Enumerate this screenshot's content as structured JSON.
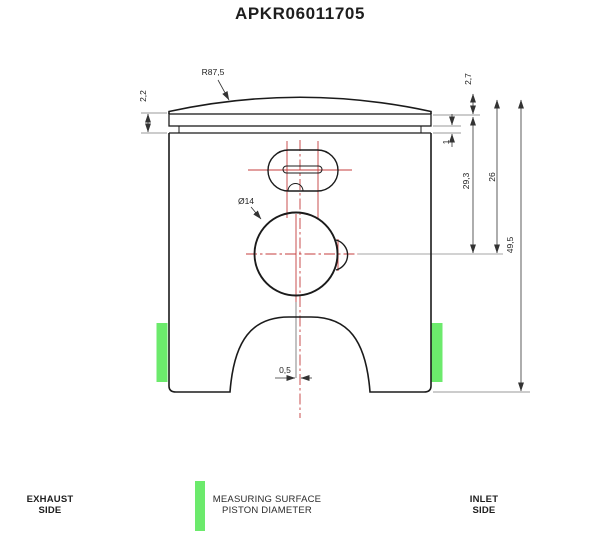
{
  "title": "APKR06011705",
  "colors": {
    "outline": "#1b1b1b",
    "dimension_line": "#444444",
    "extension_line": "#777777",
    "centerline_red": "#c43c3c",
    "measuring_green": "#6cea6c"
  },
  "dimensions": {
    "crown_radius": "R87,5",
    "top_land_height": "2,2",
    "dome_height": "2,7",
    "ring_groove_height": "1",
    "crown_edge_to_pin_center": "29,3",
    "land_to_pin_center": "26",
    "total_height": "49,5",
    "pin_bore_diameter": "Ø14",
    "center_offset": "0,5"
  },
  "legend": {
    "exhaust": {
      "line1": "EXHAUST",
      "line2": "SIDE"
    },
    "measuring_surface": {
      "line1": "MEASURING SURFACE",
      "line2": "PISTON DIAMETER"
    },
    "inlet": {
      "line1": "INLET",
      "line2": "SIDE"
    }
  }
}
